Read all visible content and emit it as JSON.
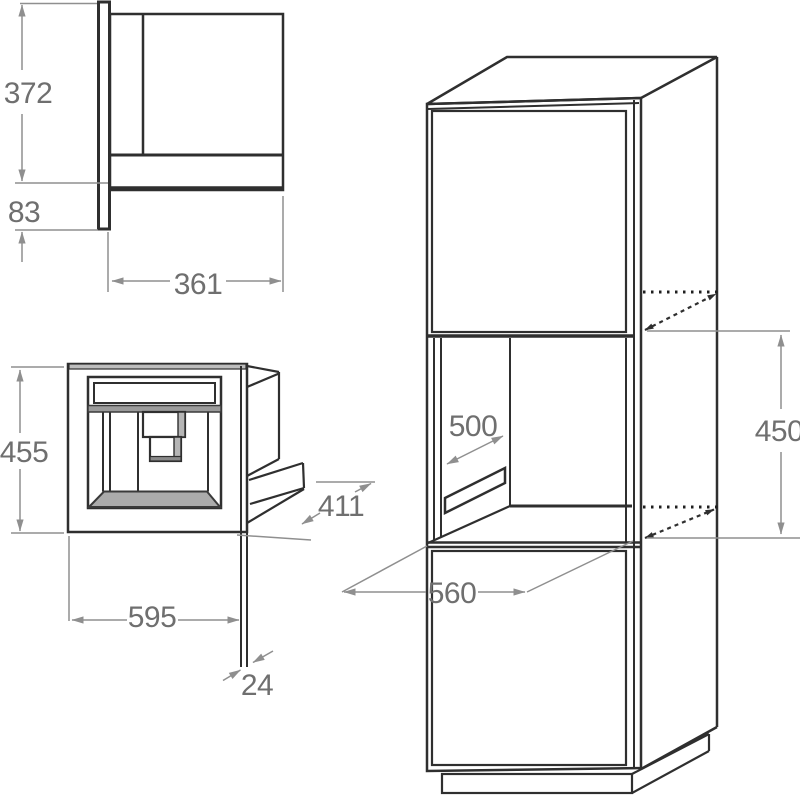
{
  "diagram": {
    "type": "appliance-installation-drawing",
    "subject": "built-in coffee machine: side view, front perspective view and tall cabinet niche",
    "unit": "mm",
    "views": {
      "side": {
        "body_height": "372",
        "lower_overhang": "83",
        "body_depth": "361"
      },
      "front": {
        "appliance_height": "455",
        "appliance_width": "595",
        "panel_thickness": "24",
        "appliance_depth": "411"
      },
      "cabinet": {
        "niche_depth": "500",
        "niche_height": "450",
        "niche_width": "560"
      }
    },
    "colors": {
      "line": "#2f2f2f",
      "dimension": "#8f8f8f",
      "label": "#6f6f6f",
      "shade": "#ababab"
    }
  }
}
